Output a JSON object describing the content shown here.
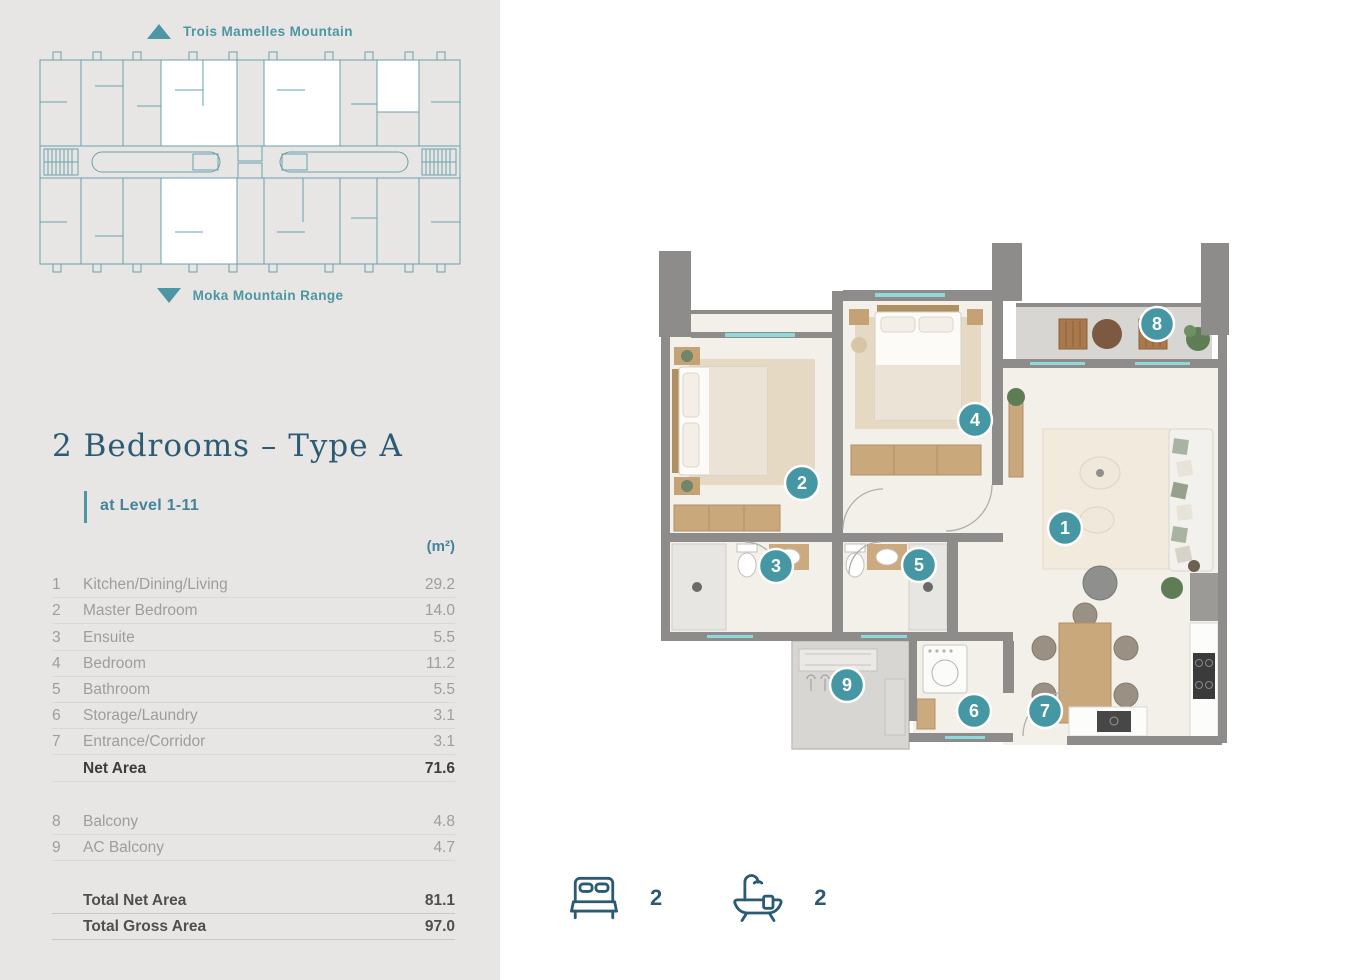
{
  "sidebar": {
    "site_plan": {
      "top_label": "Trois Mamelles Mountain",
      "bottom_label": "Moka Mountain Range"
    },
    "title": "2 Bedrooms – Type A",
    "subtitle": "at Level 1-11",
    "unit_header": "(m²)",
    "rooms": [
      {
        "num": "1",
        "label": "Kitchen/Dining/Living",
        "area": "29.2"
      },
      {
        "num": "2",
        "label": "Master Bedroom",
        "area": "14.0"
      },
      {
        "num": "3",
        "label": "Ensuite",
        "area": "5.5"
      },
      {
        "num": "4",
        "label": "Bedroom",
        "area": "11.2"
      },
      {
        "num": "5",
        "label": "Bathroom",
        "area": "5.5"
      },
      {
        "num": "6",
        "label": "Storage/Laundry",
        "area": "3.1"
      },
      {
        "num": "7",
        "label": "Entrance/Corridor",
        "area": "3.1"
      }
    ],
    "net_area": {
      "label": "Net Area",
      "area": "71.6"
    },
    "balconies": [
      {
        "num": "8",
        "label": "Balcony",
        "area": "4.8"
      },
      {
        "num": "9",
        "label": "AC Balcony",
        "area": "4.7"
      }
    ],
    "totals": [
      {
        "label": "Total Net Area",
        "area": "81.1"
      },
      {
        "label": "Total Gross Area",
        "area": "97.0"
      }
    ]
  },
  "floorplan": {
    "badge_color": "#4597a4",
    "badges": [
      {
        "num": "1",
        "room": "Kitchen/Dining/Living"
      },
      {
        "num": "2",
        "room": "Master Bedroom"
      },
      {
        "num": "3",
        "room": "Ensuite"
      },
      {
        "num": "4",
        "room": "Bedroom"
      },
      {
        "num": "5",
        "room": "Bathroom"
      },
      {
        "num": "6",
        "room": "Storage/Laundry"
      },
      {
        "num": "7",
        "room": "Entrance/Corridor"
      },
      {
        "num": "8",
        "room": "Balcony"
      },
      {
        "num": "9",
        "room": "AC Balcony"
      }
    ],
    "legend": {
      "bedrooms": "2",
      "bathrooms": "2"
    }
  },
  "colors": {
    "sidebar_bg": "#e7e6e4",
    "accent_teal": "#4d96a3",
    "title_teal": "#2d5b74",
    "wall_gray": "#8d8c8a",
    "window_cyan": "#8fd8dc"
  }
}
